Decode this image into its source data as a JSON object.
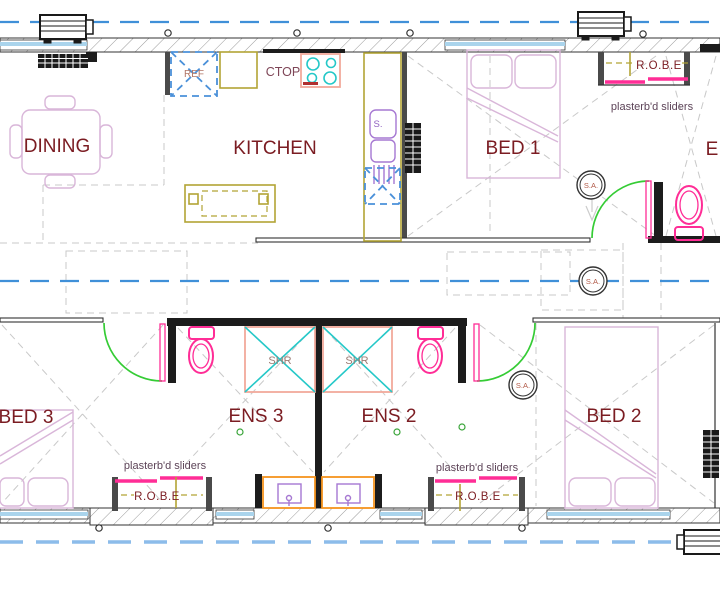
{
  "drawing": {
    "type": "residential floor plan",
    "rooms_visible": [
      "DINING",
      "KITCHEN",
      "BED 1",
      "BED 2",
      "BED 3",
      "ENS 2",
      "ENS 3"
    ]
  },
  "labels": {
    "dining": "DINING",
    "kitchen": "KITCHEN",
    "bed1": "BED 1",
    "bed2": "BED 2",
    "bed3": "BED 3",
    "ens2": "ENS 2",
    "ens3": "ENS 3",
    "ens_partial": "E",
    "robe": "R.O.B.E",
    "ref": "REF",
    "cooktop": "CTOP",
    "sink": "S.",
    "shower": "SHR",
    "smoke_alarm": "S.A.",
    "sliders_note": "plasterb'd sliders"
  },
  "colors": {
    "label_text": "#7b1c22",
    "annotation_text": "#5d4458",
    "ref_text": "#b07465",
    "shr_text": "#9b7b73",
    "ctop_text": "#7e4657",
    "sink_text": "#9061c0",
    "sa_text": "#b25a48",
    "wall": "#333333",
    "wall_dark": "#1c1c1c",
    "hatch": "#9a9a9a",
    "glass": "#aad4ec",
    "guide_blue": "#4090d8",
    "guide_blue_light": "#8cbcea",
    "gray_dash": "#c9c9c9",
    "magenta": "#ff2d96",
    "green": "#35cc35",
    "cyan": "#25c8c8",
    "olive": "#b2a435",
    "salmon": "#f2a99b",
    "orange": "#f5941e",
    "purple": "#a678d2",
    "thistle": "#d9b6d9",
    "ref_blue": "#4a90d9"
  }
}
